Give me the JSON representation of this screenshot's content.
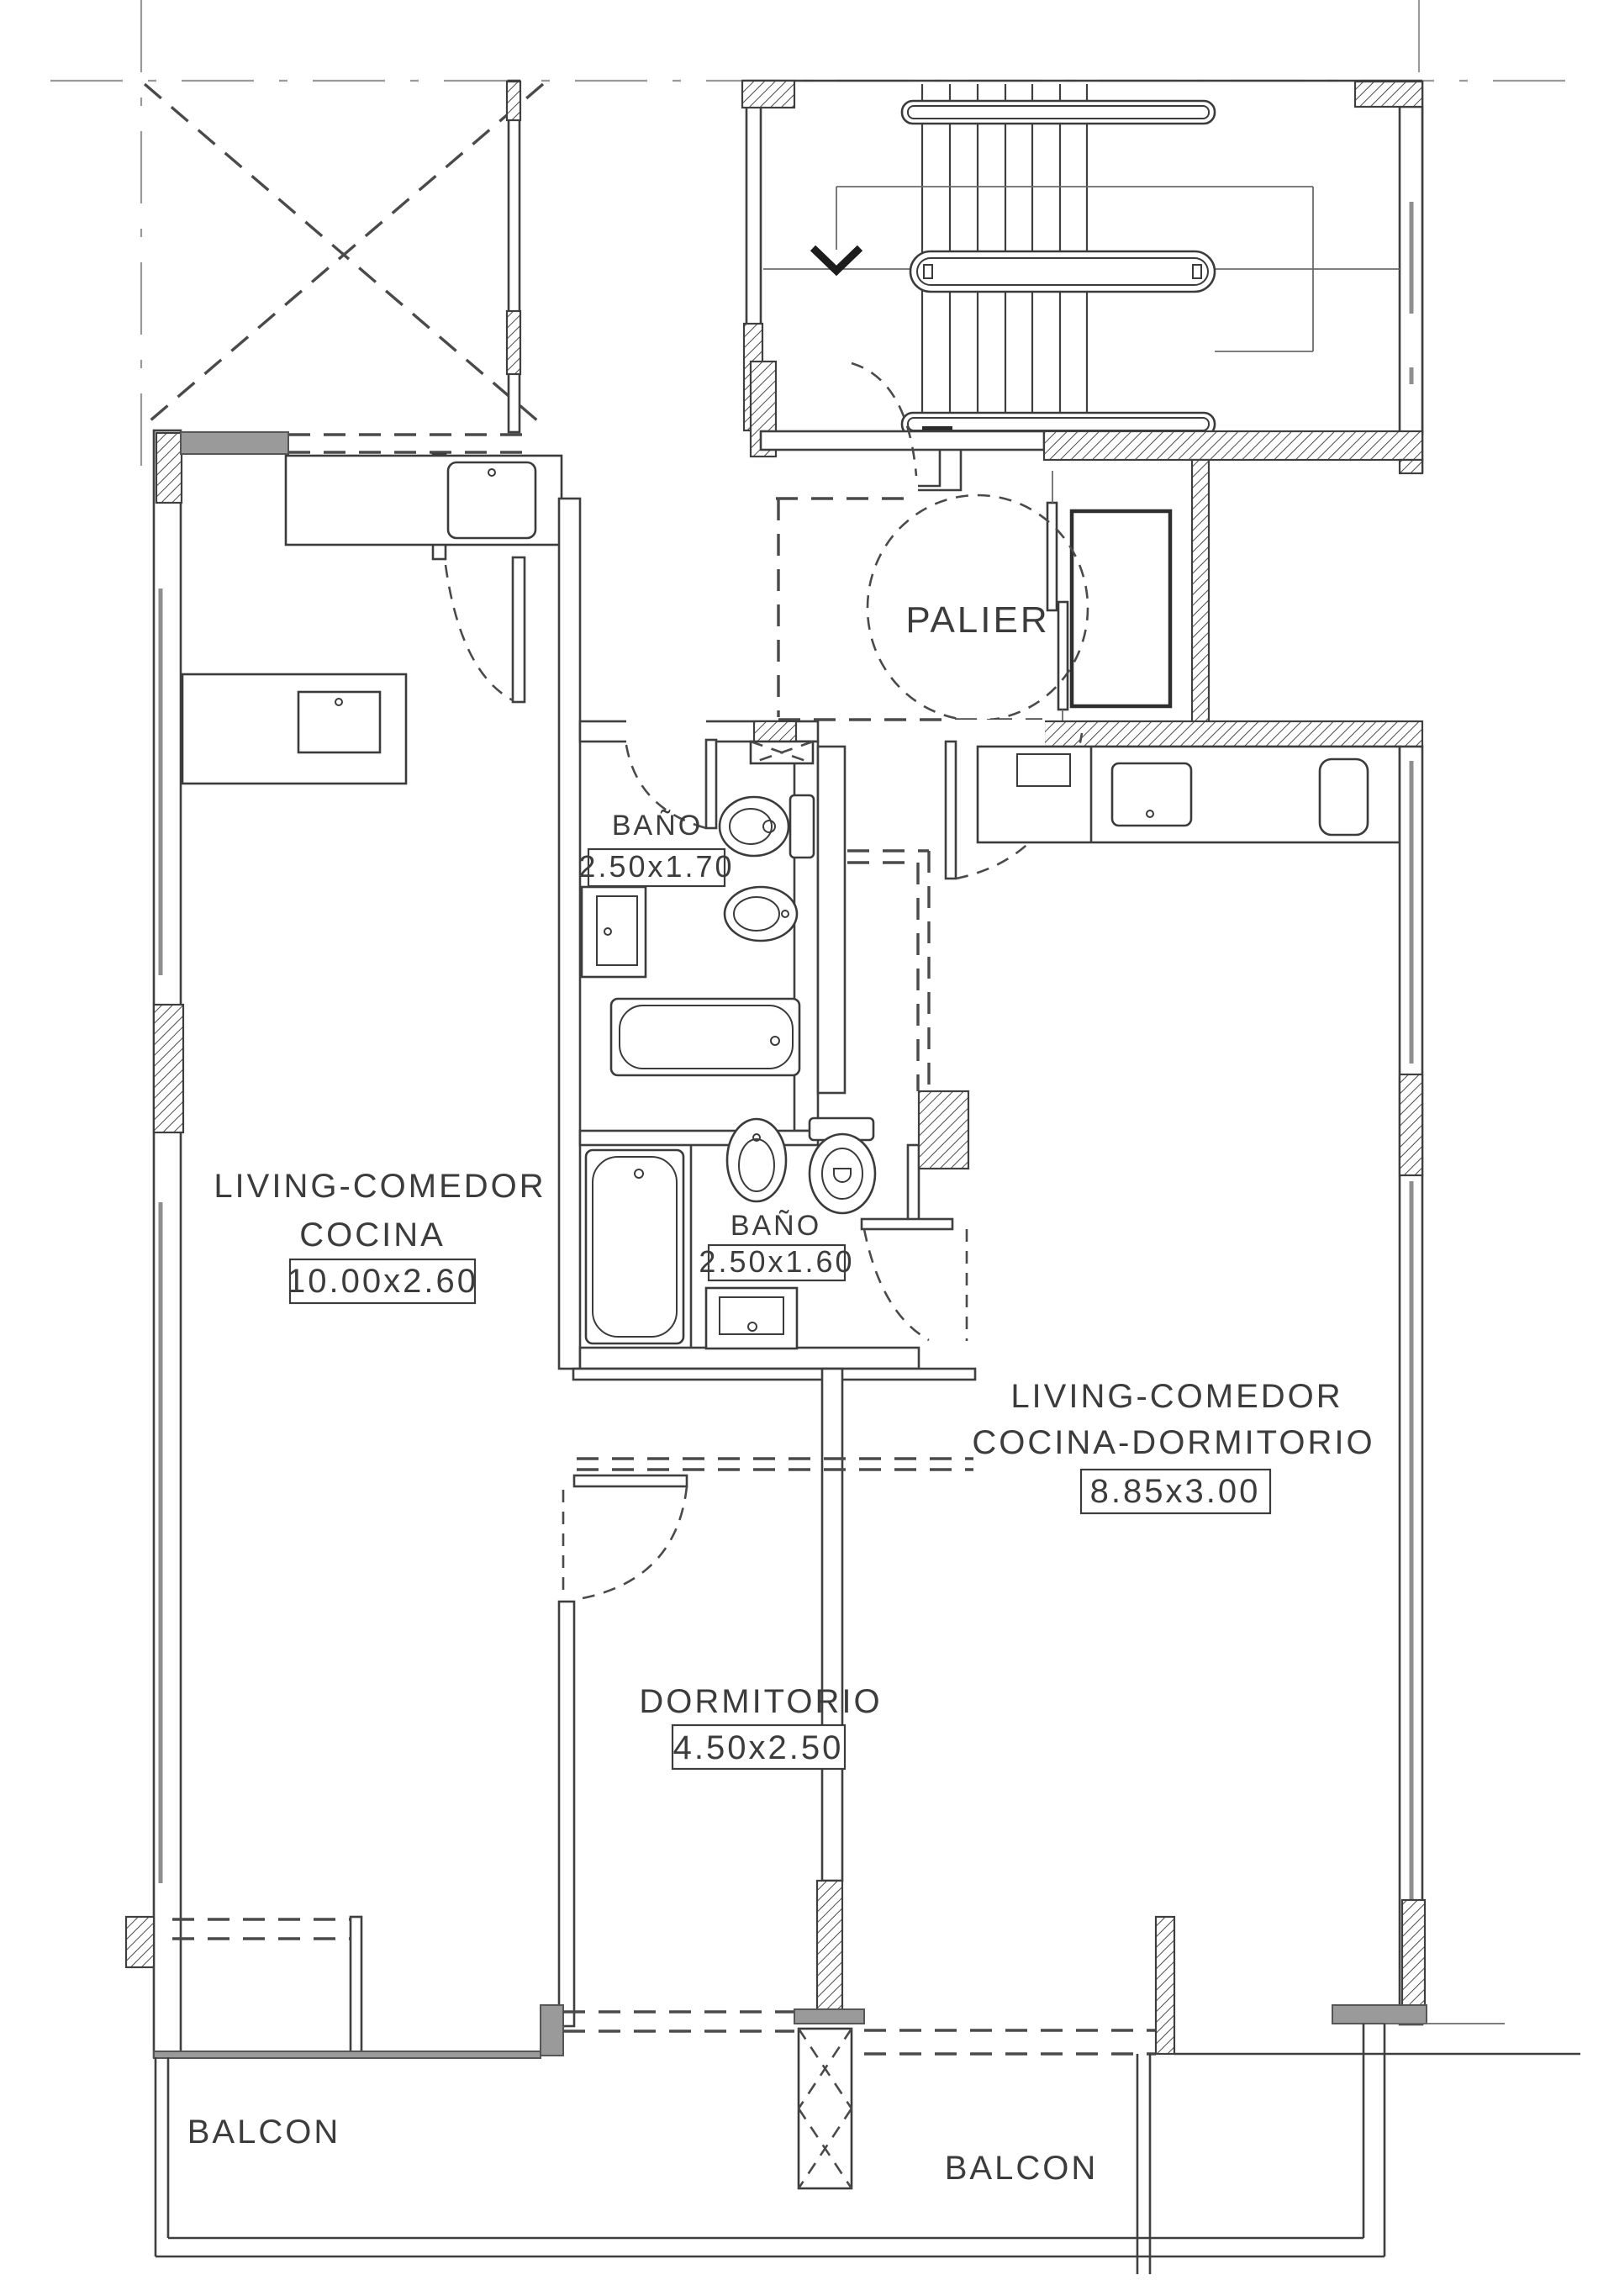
{
  "title": "floor-plan",
  "rooms": {
    "palier": {
      "label": "PALIER"
    },
    "bath1": {
      "label": "BAÑO",
      "dims": "2.50x1.70"
    },
    "bath2": {
      "label": "BAÑO",
      "dims": "2.50x1.60"
    },
    "living_left": {
      "line1": "LIVING-COMEDOR",
      "line2": "COCINA",
      "dims": "10.00x2.60"
    },
    "living_right": {
      "line1": "LIVING-COMEDOR",
      "line2": "COCINA-DORMITORIO",
      "dims": "8.85x3.00"
    },
    "bedroom": {
      "label": "DORMITORIO",
      "dims": "4.50x2.50"
    },
    "balcony_left": {
      "label": "BALCON"
    },
    "balcony_right": {
      "label": "BALCON"
    }
  },
  "colors": {
    "line": "#3f3f3f",
    "wall_gray": "#9a9a9a",
    "grid_gray": "#9a9a9a",
    "background": "#ffffff"
  }
}
